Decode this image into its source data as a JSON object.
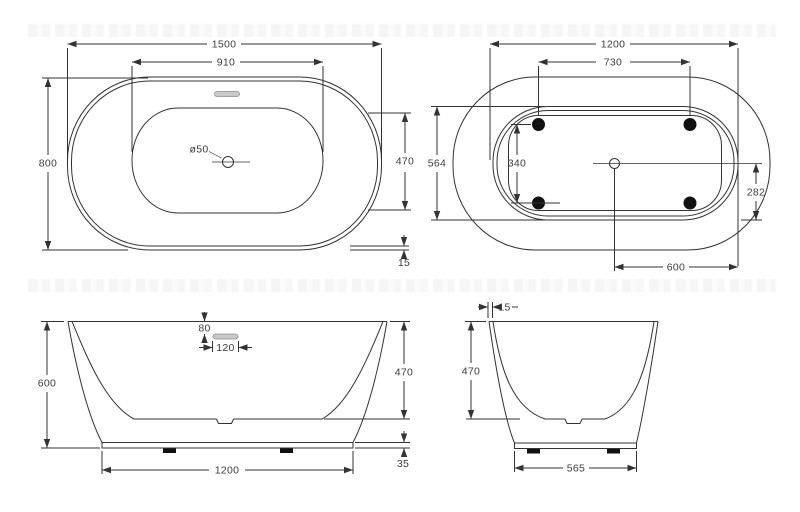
{
  "drawing": {
    "views": {
      "top": {
        "dims": {
          "overall_length": "1500",
          "basin_length": "910",
          "overall_width": "800",
          "basin_width": "470",
          "rim_lip": "15",
          "drain_diameter": "ø50"
        }
      },
      "bottom": {
        "dims": {
          "base_length": "1200",
          "feet_span_length": "730",
          "base_width": "564",
          "feet_span_width": "340",
          "drain_offset_width": "282",
          "drain_offset_length": "600"
        }
      },
      "front": {
        "dims": {
          "overall_height": "600",
          "overflow_drop": "80",
          "overflow_length": "120",
          "basin_depth": "470",
          "plinth_height": "35",
          "base_length": "1200"
        }
      },
      "side": {
        "dims": {
          "wall_thickness": "15",
          "basin_depth": "470",
          "base_width": "565"
        }
      }
    },
    "colors": {
      "line": "#333333",
      "text": "#3d3d3d",
      "overflow_fill": "#c9c9c9",
      "overflow_stroke": "#8f8f8f",
      "feet": "#111111",
      "background": "#ffffff"
    }
  }
}
